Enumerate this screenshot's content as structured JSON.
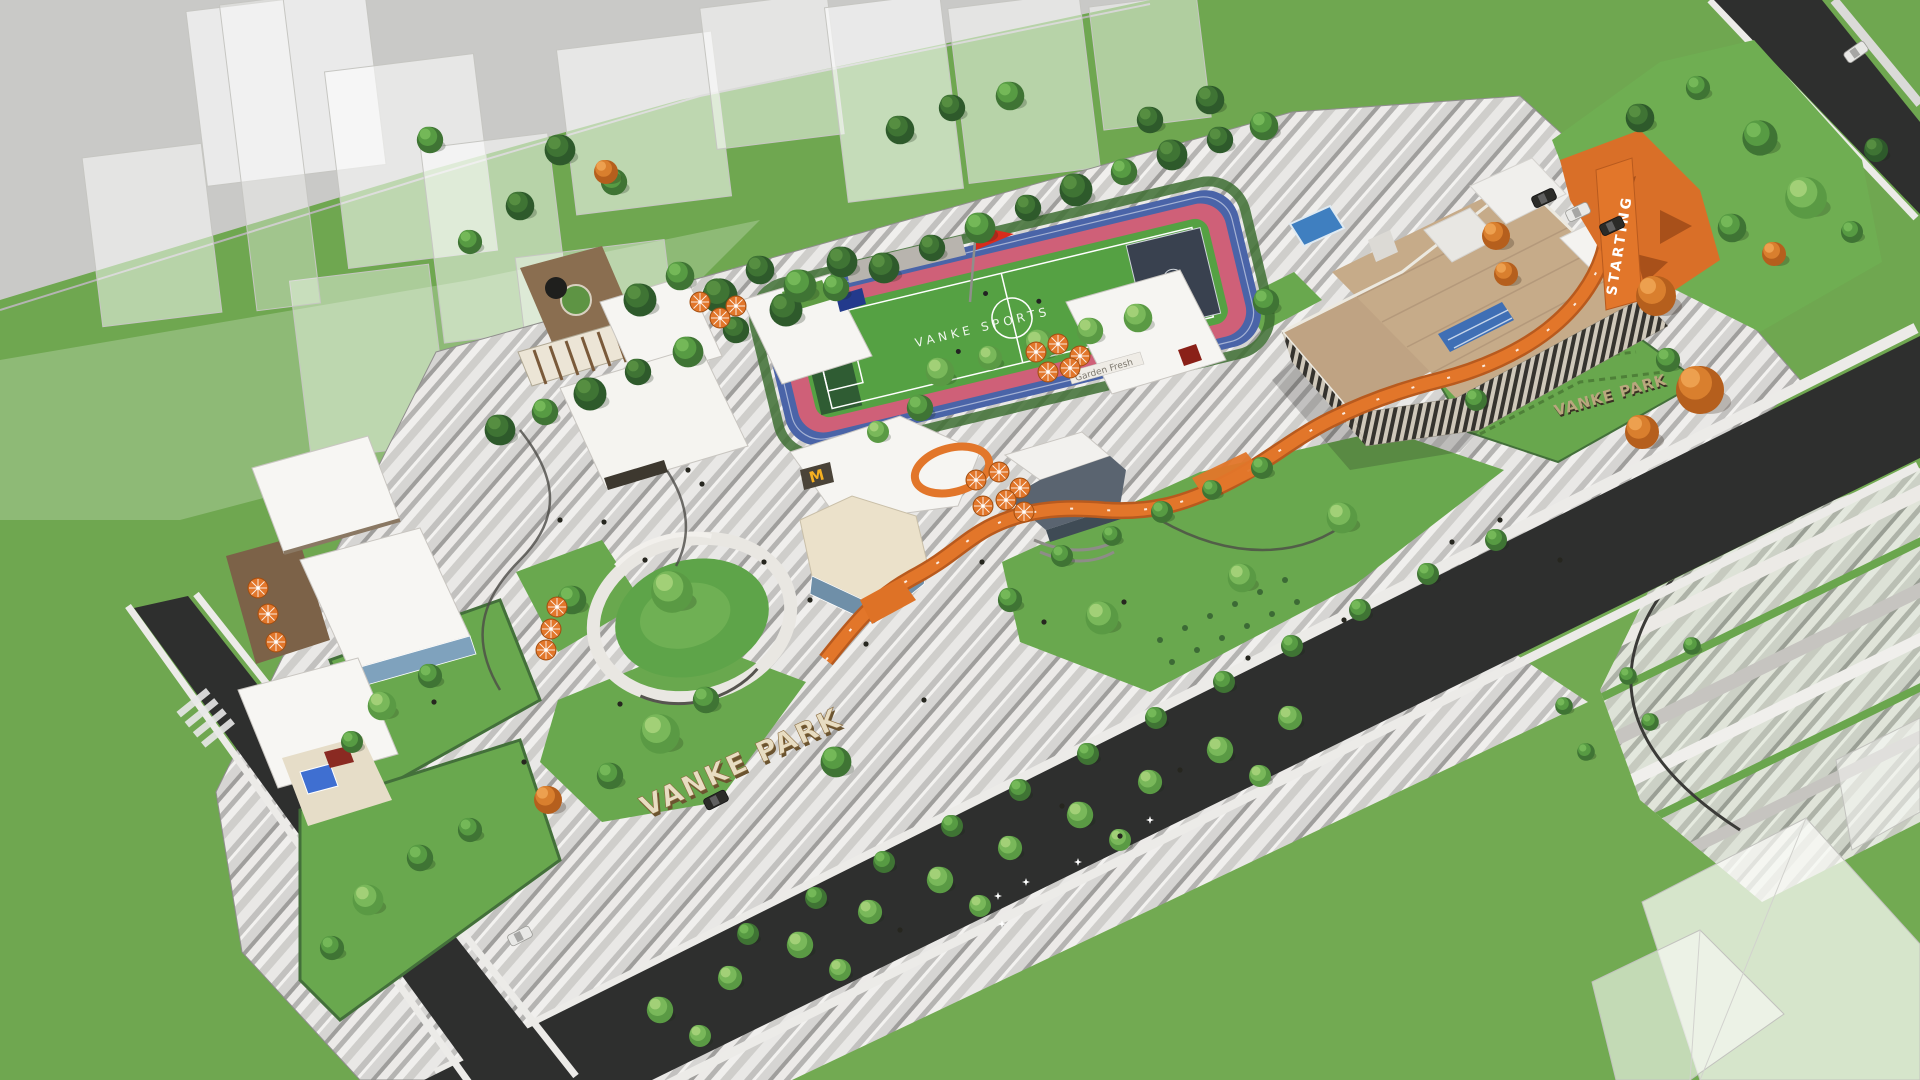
{
  "meta": {
    "title": "Vanke Park — aerial masterplan render"
  },
  "labels": {
    "park_name_main": "VANKE PARK",
    "park_name_secondary": "VANKE PARK",
    "track_text": "STARTING",
    "field_text": "VANKE SPORTS",
    "mcdonalds_logo": "M",
    "shop_sign": "Garden Fresh"
  },
  "colors": {
    "grass": "#6fa750",
    "lawn": "#69a84e",
    "road": "#2e2f2e",
    "paving_light": "#efeeec",
    "paving_dark": "#a9a8a6",
    "orange_path": "#e2762a",
    "track_blue": "#4a64a8",
    "track_pink": "#cf6078",
    "field_green": "#55a143",
    "roof_white": "#f6f5f2",
    "roof_tan": "#c6ab89",
    "flag_red": "#d92b1c",
    "glass_blue": "#7fa2bd",
    "wood_deck": "#8a6e50"
  },
  "scene": {
    "trees": [
      [
        500,
        430,
        1.4,
        "d"
      ],
      [
        545,
        412,
        1.2,
        "m"
      ],
      [
        590,
        394,
        1.5,
        "d"
      ],
      [
        638,
        372,
        1.2,
        "d"
      ],
      [
        688,
        352,
        1.4,
        "m"
      ],
      [
        736,
        330,
        1.2,
        "d"
      ],
      [
        786,
        310,
        1.5,
        "d"
      ],
      [
        836,
        288,
        1.2,
        "m"
      ],
      [
        884,
        268,
        1.4,
        "d"
      ],
      [
        932,
        248,
        1.2,
        "d"
      ],
      [
        980,
        228,
        1.4,
        "m"
      ],
      [
        1028,
        208,
        1.2,
        "d"
      ],
      [
        1076,
        190,
        1.5,
        "d"
      ],
      [
        1124,
        172,
        1.2,
        "m"
      ],
      [
        1172,
        155,
        1.4,
        "d"
      ],
      [
        1220,
        140,
        1.2,
        "d"
      ],
      [
        1264,
        126,
        1.3,
        "m"
      ],
      [
        640,
        300,
        1.5,
        "d"
      ],
      [
        680,
        276,
        1.3,
        "m"
      ],
      [
        720,
        296,
        1.6,
        "d"
      ],
      [
        760,
        270,
        1.3,
        "d"
      ],
      [
        800,
        286,
        1.5,
        "m"
      ],
      [
        842,
        262,
        1.4,
        "d"
      ],
      [
        940,
        372,
        1.3,
        "l"
      ],
      [
        990,
        358,
        1.1,
        "l"
      ],
      [
        1040,
        345,
        1.4,
        "l"
      ],
      [
        1090,
        331,
        1.2,
        "l"
      ],
      [
        1138,
        318,
        1.3,
        "l"
      ],
      [
        560,
        150,
        1.4,
        "d"
      ],
      [
        614,
        182,
        1.2,
        "m"
      ],
      [
        520,
        206,
        1.3,
        "d"
      ],
      [
        470,
        242,
        1.1,
        "m"
      ],
      [
        606,
        172,
        1.2,
        "o"
      ],
      [
        900,
        130,
        1.3,
        "d"
      ],
      [
        952,
        108,
        1.2,
        "d"
      ],
      [
        1010,
        96,
        1.3,
        "m"
      ],
      [
        1150,
        120,
        1.2,
        "d"
      ],
      [
        1210,
        100,
        1.3,
        "d"
      ],
      [
        430,
        140,
        1.2,
        "m"
      ],
      [
        1640,
        118,
        1.3,
        "d"
      ],
      [
        1698,
        88,
        1.1,
        "m"
      ],
      [
        1760,
        138,
        1.6,
        "m"
      ],
      [
        1806,
        198,
        1.9,
        "l"
      ],
      [
        1732,
        228,
        1.3,
        "m"
      ],
      [
        1852,
        232,
        1.0,
        "m"
      ],
      [
        1774,
        254,
        1.2,
        "o"
      ],
      [
        1876,
        150,
        1.1,
        "d"
      ],
      [
        1496,
        236,
        1.4,
        "o"
      ],
      [
        1506,
        274,
        1.2,
        "o"
      ],
      [
        1062,
        556,
        1.0,
        "m"
      ],
      [
        1112,
        536,
        0.9,
        "m"
      ],
      [
        1162,
        512,
        1.0,
        "m"
      ],
      [
        1212,
        490,
        0.9,
        "m"
      ],
      [
        1262,
        468,
        1.0,
        "m"
      ],
      [
        1102,
        618,
        1.5,
        "l"
      ],
      [
        1242,
        578,
        1.3,
        "l"
      ],
      [
        1342,
        518,
        1.4,
        "l"
      ],
      [
        1010,
        600,
        1.1,
        "m"
      ],
      [
        920,
        408,
        1.2,
        "m"
      ],
      [
        878,
        432,
        1.0,
        "l"
      ],
      [
        672,
        592,
        1.9,
        "l"
      ],
      [
        572,
        600,
        1.3,
        "m"
      ],
      [
        660,
        734,
        1.8,
        "l"
      ],
      [
        610,
        776,
        1.2,
        "m"
      ],
      [
        706,
        700,
        1.2,
        "m"
      ],
      [
        382,
        706,
        1.3,
        "l"
      ],
      [
        430,
        676,
        1.1,
        "m"
      ],
      [
        352,
        742,
        1.0,
        "m"
      ],
      [
        368,
        900,
        1.4,
        "l"
      ],
      [
        420,
        858,
        1.2,
        "m"
      ],
      [
        332,
        948,
        1.1,
        "m"
      ],
      [
        548,
        800,
        1.4,
        "o"
      ],
      [
        470,
        830,
        1.1,
        "m"
      ],
      [
        660,
        1010,
        1.2,
        "l"
      ],
      [
        730,
        978,
        1.1,
        "l"
      ],
      [
        800,
        945,
        1.2,
        "l"
      ],
      [
        870,
        912,
        1.1,
        "l"
      ],
      [
        940,
        880,
        1.2,
        "l"
      ],
      [
        1010,
        848,
        1.1,
        "l"
      ],
      [
        1080,
        815,
        1.2,
        "l"
      ],
      [
        1150,
        782,
        1.1,
        "l"
      ],
      [
        1220,
        750,
        1.2,
        "l"
      ],
      [
        1290,
        718,
        1.1,
        "l"
      ],
      [
        700,
        1036,
        1.0,
        "l"
      ],
      [
        840,
        970,
        1.0,
        "l"
      ],
      [
        980,
        906,
        1.0,
        "l"
      ],
      [
        1120,
        840,
        1.0,
        "l"
      ],
      [
        1260,
        776,
        1.0,
        "l"
      ],
      [
        836,
        762,
        1.4,
        "m"
      ],
      [
        1496,
        540,
        1.0,
        "m"
      ],
      [
        1428,
        574,
        1.0,
        "m"
      ],
      [
        1360,
        610,
        1.0,
        "m"
      ],
      [
        1292,
        646,
        1.0,
        "m"
      ],
      [
        1224,
        682,
        1.0,
        "m"
      ],
      [
        1156,
        718,
        1.0,
        "m"
      ],
      [
        1088,
        754,
        1.0,
        "m"
      ],
      [
        1020,
        790,
        1.0,
        "m"
      ],
      [
        952,
        826,
        1.0,
        "m"
      ],
      [
        884,
        862,
        1.0,
        "m"
      ],
      [
        816,
        898,
        1.0,
        "m"
      ],
      [
        748,
        934,
        1.0,
        "m"
      ],
      [
        1564,
        706,
        0.8,
        "m"
      ],
      [
        1628,
        676,
        0.8,
        "m"
      ],
      [
        1692,
        646,
        0.8,
        "m"
      ],
      [
        1586,
        752,
        0.8,
        "m"
      ],
      [
        1650,
        722,
        0.8,
        "m"
      ],
      [
        1266,
        302,
        1.2,
        "m"
      ],
      [
        1476,
        400,
        1.0,
        "m"
      ],
      [
        1668,
        360,
        1.1,
        "m"
      ],
      [
        1656,
        296,
        2.0,
        "o"
      ],
      [
        1700,
        390,
        2.4,
        "o"
      ],
      [
        1642,
        432,
        1.7,
        "o"
      ]
    ],
    "umbrellas": [
      [
        258,
        588
      ],
      [
        268,
        614
      ],
      [
        276,
        642
      ],
      [
        557,
        607
      ],
      [
        551,
        629
      ],
      [
        546,
        650
      ],
      [
        700,
        302
      ],
      [
        720,
        318
      ],
      [
        736,
        306
      ],
      [
        1036,
        352
      ],
      [
        1058,
        344
      ],
      [
        1080,
        356
      ],
      [
        1048,
        372
      ],
      [
        1070,
        368
      ],
      [
        976,
        480
      ],
      [
        999,
        472
      ],
      [
        1020,
        488
      ],
      [
        983,
        506
      ],
      [
        1006,
        500
      ],
      [
        1024,
        512
      ]
    ],
    "people": [
      [
        604,
        522
      ],
      [
        645,
        560
      ],
      [
        702,
        484
      ],
      [
        764,
        562
      ],
      [
        866,
        644
      ],
      [
        924,
        700
      ],
      [
        1124,
        602
      ],
      [
        620,
        704
      ],
      [
        524,
        762
      ],
      [
        982,
        562
      ],
      [
        1044,
        622
      ],
      [
        434,
        702
      ],
      [
        1344,
        620
      ],
      [
        1452,
        542
      ],
      [
        1248,
        658
      ],
      [
        688,
        470
      ],
      [
        560,
        520
      ],
      [
        810,
        600
      ],
      [
        1500,
        520
      ],
      [
        1560,
        560
      ],
      [
        1062,
        806
      ],
      [
        1120,
        836
      ],
      [
        900,
        930
      ],
      [
        1180,
        770
      ]
    ],
    "flowers": [
      [
        998,
        896
      ],
      [
        1026,
        882
      ],
      [
        1002,
        924
      ],
      [
        1078,
        862
      ],
      [
        1150,
        820
      ]
    ],
    "cars": [
      [
        1544,
        198,
        -25,
        "dark"
      ],
      [
        1578,
        212,
        -25,
        "white"
      ],
      [
        1612,
        226,
        -25,
        "dark"
      ],
      [
        716,
        800,
        -27,
        "dark"
      ],
      [
        520,
        936,
        -27,
        "white"
      ],
      [
        1856,
        52,
        -35,
        "white"
      ]
    ]
  }
}
